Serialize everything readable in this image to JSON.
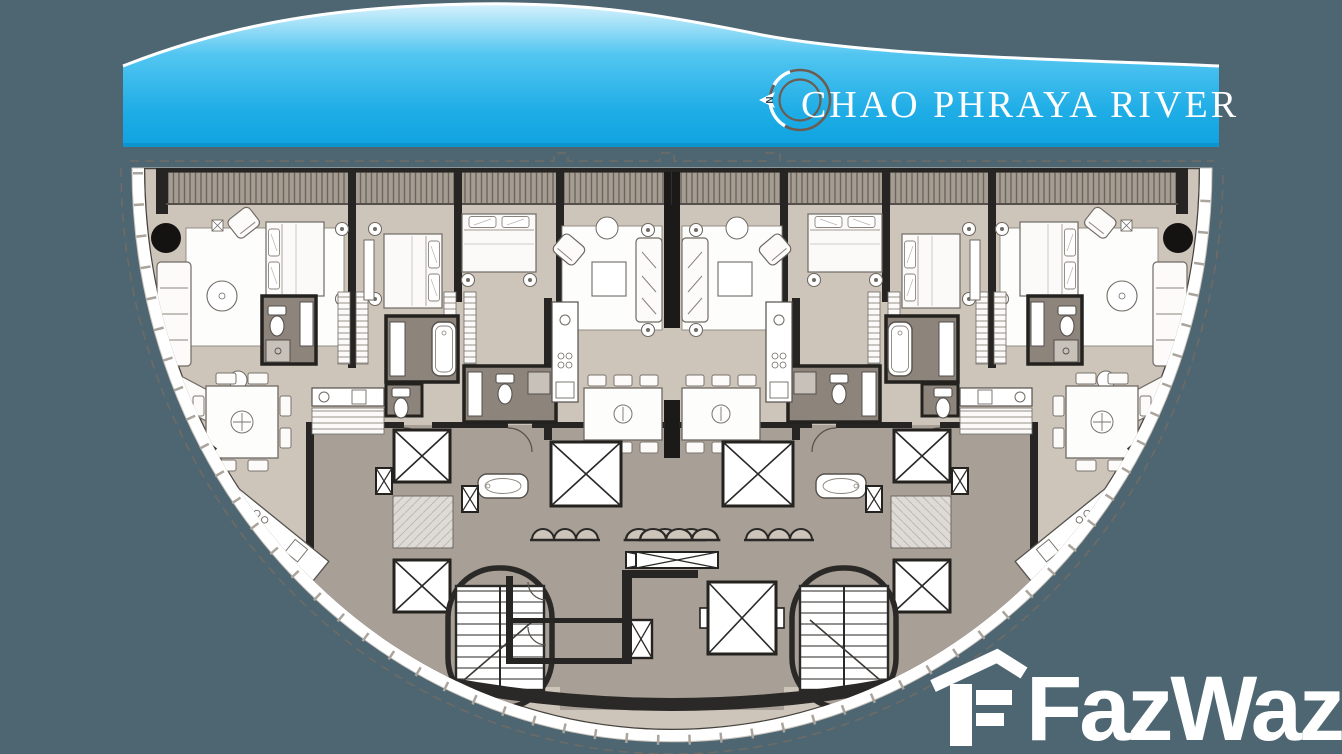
{
  "banner": {
    "label": "CHAO PHRAYA RIVER",
    "text_color": "#ffffff",
    "gradient_top": "#d7f2fc",
    "gradient_mid": "#53c6f1",
    "gradient_bottom": "#0fa3e0",
    "compass": {
      "icon": "compass-north-icon",
      "letter": "N"
    }
  },
  "watermark": {
    "brand": "FazWaz",
    "icon": "fazwaz-house-logo-icon",
    "color": "#ffffff"
  },
  "floorplan": {
    "kind": "semicircular residential tower floor plan",
    "orientation": "river to the north (top)",
    "palette": {
      "background": "#4d6671",
      "unit_floor": "#cdc4ba",
      "corridor": "#a89f96",
      "bathroom": "#8d847c",
      "balcony_strip": "#a59c92",
      "walls": "#262523",
      "facade_band": "#ffffff",
      "lobby_light": "#dedbd7"
    },
    "features": [
      "balcony-strip",
      "residential-units",
      "bedrooms",
      "living-rooms",
      "dining-tables",
      "kitchens",
      "bathrooms",
      "bathtubs",
      "toilets",
      "passenger-elevators",
      "service-elevator",
      "stairwells",
      "corridor-core",
      "round-columns",
      "door-swings",
      "property-boundary-dashed"
    ]
  }
}
